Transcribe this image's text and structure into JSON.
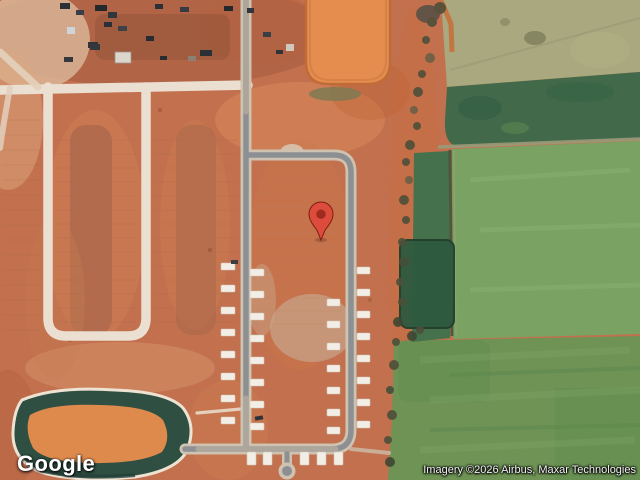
{
  "page": {
    "width": 640,
    "height": 480,
    "kind": "google-maps-satellite-view"
  },
  "map": {
    "provider": "Google",
    "view": "satellite",
    "logo_text": "Google",
    "attribution_text": "Imagery ©2026 Airbus, Maxar Technologies",
    "marker": {
      "name": "red-location-pin",
      "tip_x": 321,
      "tip_y": 240,
      "body_color": "#DD4B3C",
      "outline_color": "#7E1D12",
      "inner_dot_color": "#9E2B1E"
    },
    "scene_palette": {
      "dirt_base": "#c2704e",
      "dirt_dark": "#a05a3e",
      "dirt_light": "#dcb69c",
      "graded_road": "#ebdfd2",
      "paved_asphalt": "#8d9093",
      "road_shoulder": "#cfc2b0",
      "concrete_slab": "#f2eee6",
      "pond_water": "#de8a4c",
      "pond_vegetation": "#2e4f42",
      "field_pale_olive": "#a9a87f",
      "field_dark_green": "#41694a",
      "field_medium_green": "#6e9355",
      "field_light_green": "#79a263",
      "scrub_trees": "#4e4f39"
    }
  }
}
